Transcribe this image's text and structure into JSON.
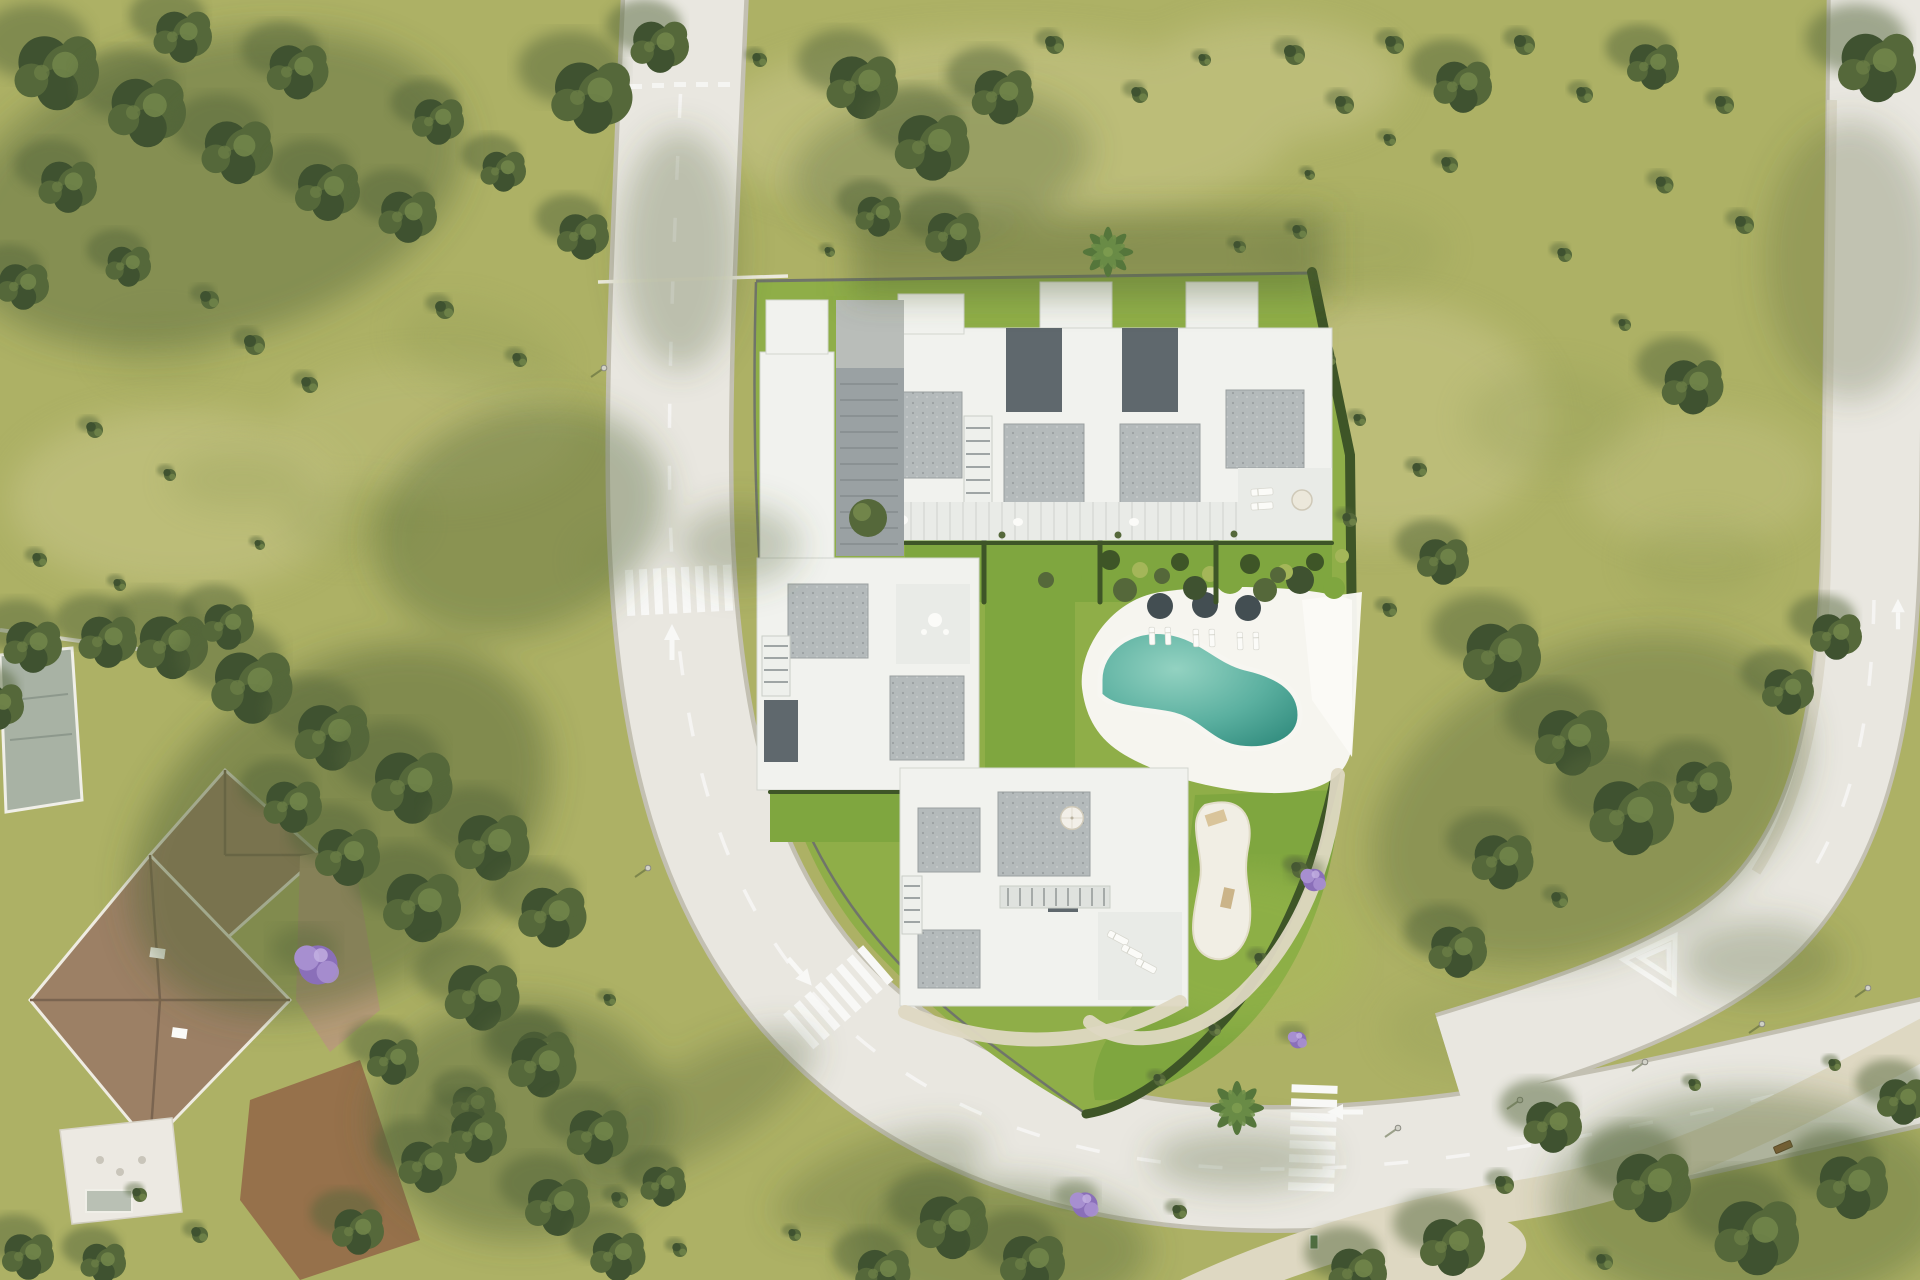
{
  "scene": {
    "kind": "aerial-architectural-render",
    "subject": "residential development site plan with four white apartment blocks, communal pool garden, curved perimeter road, neighbouring villa and golf-course style grassland",
    "inventory": {
      "apartment_blocks": 4,
      "pool": 1,
      "pool_parasols": 3,
      "garden_umbrellas": 2,
      "crosswalks": 3,
      "road_arrows": 5,
      "benches": 2,
      "street_lamps": 8,
      "neighbour_villas": 1
    }
  },
  "colors": {
    "grass_base": "#adb165",
    "grass_pale": "#c8c689",
    "grass_dark": "#8e9a55",
    "shade": "#55663a",
    "lawn_mid": "#8fae48",
    "lawn_bright": "#7fa63f",
    "hedge": "#3e5527",
    "tree_dark": "#3f5230",
    "tree_mid": "#55683a",
    "tree_light": "#71854a",
    "road": "#e9e7e0",
    "curb": "#c3c0b2",
    "marking": "#f8f8f6",
    "path": "#ded8c2",
    "deck": "#f6f5ef",
    "pool_light": "#93d2c1",
    "pool_mid": "#5bb0a0",
    "pool_dark": "#2f8a7c",
    "building": "#f1f2ee",
    "roof_gravel": "#b4babb",
    "roof_dark": "#5f686d",
    "terrace": "#e9ebe7",
    "villa_roof": "#9c8065",
    "villa_roof_dark": "#7a6450",
    "villa_roof2": "#a8b2a4",
    "villa_wall": "#ece9e2",
    "driveway": "#b79c79",
    "soil": "#96714b",
    "purple_light": "#a78fd0",
    "purple_dark": "#8a6fb9",
    "bench": "#8a5a33",
    "wall": "#70756a",
    "sand": "#f1eee4",
    "umbrella_dark": "#434e52"
  }
}
